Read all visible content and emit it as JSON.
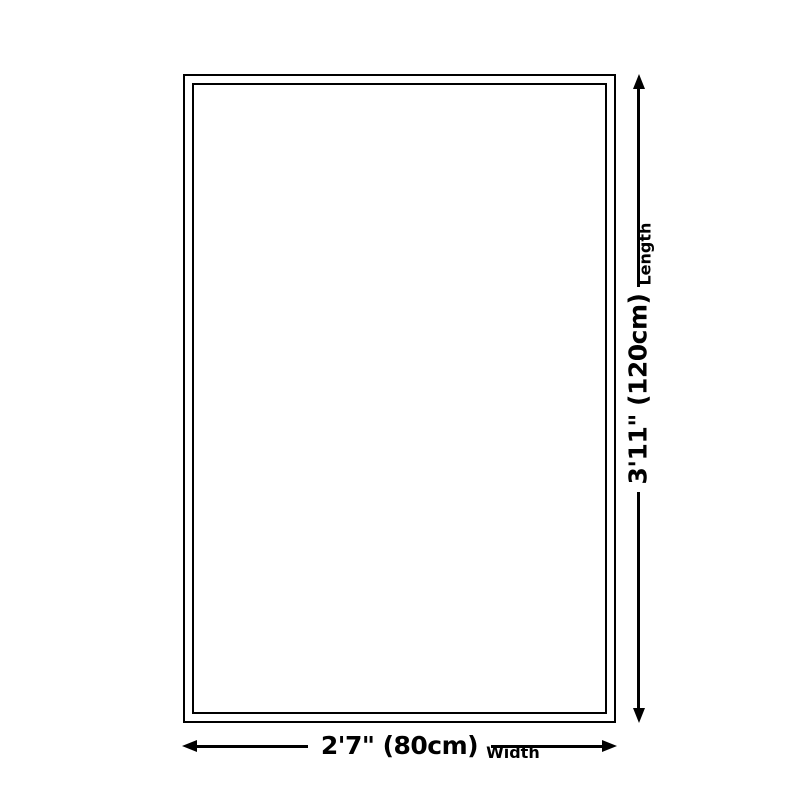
{
  "diagram": {
    "background_color": "#ffffff",
    "line_color": "#000000",
    "shape": "rectangle-double-border"
  },
  "dimensions": {
    "length": {
      "value": "3'11\" (120cm)",
      "axis": "Length",
      "arrow_icon": "double-headed-vertical-arrow"
    },
    "width": {
      "value": "2'7\" (80cm)",
      "axis": "Width",
      "arrow_icon": "double-headed-horizontal-arrow"
    }
  }
}
